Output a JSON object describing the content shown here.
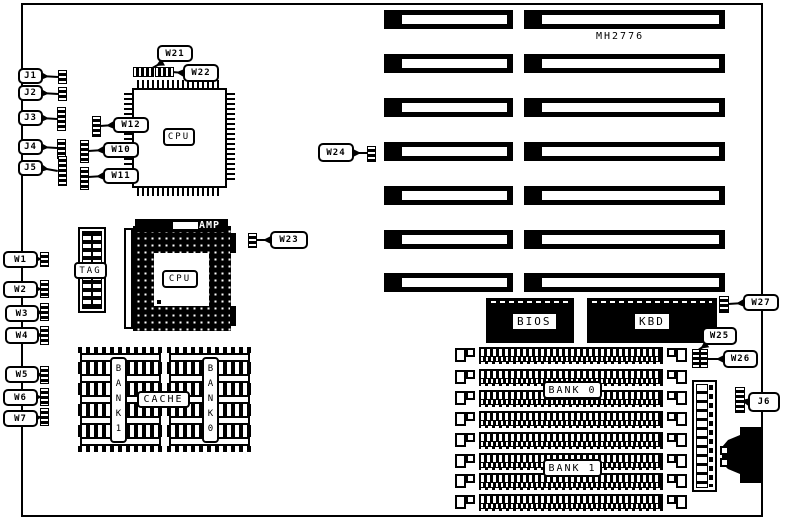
{
  "board": {
    "marking": "MH2776",
    "ink_color": "#000000",
    "paper_color": "#ffffff"
  },
  "labels": {
    "cpu_qfp": "CPU",
    "cpu_pga": "CPU",
    "amp": "AMP",
    "tag": "TAG",
    "cache": "CACHE",
    "cache_bank1": "BANK1",
    "cache_bank0": "BANK0",
    "bios": "BIOS",
    "kbd": "KBD",
    "mem_bank0": "BANK 0",
    "mem_bank1": "BANK 1"
  },
  "callouts": [
    {
      "id": "J1",
      "label": "J1",
      "box": [
        18,
        68,
        25,
        16
      ],
      "jumpers": [
        [
          58,
          70,
          9,
          14,
          "v"
        ]
      ],
      "leader": [
        41,
        76,
        58,
        77
      ]
    },
    {
      "id": "J2",
      "label": "J2",
      "box": [
        18,
        85,
        25,
        16
      ],
      "jumpers": [
        [
          58,
          87,
          9,
          14,
          "v"
        ]
      ],
      "leader": [
        41,
        93,
        58,
        94
      ]
    },
    {
      "id": "J3",
      "label": "J3",
      "box": [
        18,
        110,
        25,
        16
      ],
      "jumpers": [
        [
          57,
          107,
          9,
          24,
          "v"
        ]
      ],
      "leader": [
        41,
        118,
        57,
        119
      ]
    },
    {
      "id": "J4",
      "label": "J4",
      "box": [
        18,
        139,
        25,
        16
      ],
      "jumpers": [
        [
          57,
          139,
          9,
          20,
          "v"
        ]
      ],
      "leader": [
        41,
        147,
        57,
        148
      ]
    },
    {
      "id": "J5",
      "label": "J5",
      "box": [
        18,
        160,
        25,
        16
      ],
      "jumpers": [
        [
          58,
          156,
          9,
          30,
          "v"
        ]
      ],
      "leader": [
        41,
        168,
        58,
        171
      ]
    },
    {
      "id": "W1",
      "label": "W1",
      "box": [
        3,
        251,
        35,
        17
      ],
      "jumpers": [
        [
          40,
          252,
          9,
          15,
          "v"
        ]
      ],
      "leader": [
        34,
        259,
        41,
        259
      ]
    },
    {
      "id": "W2",
      "label": "W2",
      "box": [
        3,
        281,
        35,
        17
      ],
      "jumpers": [
        [
          40,
          280,
          9,
          18,
          "v"
        ]
      ],
      "leader": [
        34,
        289,
        41,
        289
      ]
    },
    {
      "id": "W3",
      "label": "W3",
      "box": [
        5,
        305,
        34,
        17
      ],
      "jumpers": [
        [
          40,
          303,
          9,
          18,
          "v"
        ]
      ],
      "leader": [
        35,
        313,
        41,
        312
      ]
    },
    {
      "id": "W4",
      "label": "W4",
      "box": [
        5,
        327,
        34,
        17
      ],
      "jumpers": [
        [
          40,
          326,
          9,
          19,
          "v"
        ]
      ],
      "leader": [
        35,
        335,
        41,
        335
      ]
    },
    {
      "id": "W5",
      "label": "W5",
      "box": [
        5,
        366,
        34,
        17
      ],
      "jumpers": [
        [
          40,
          366,
          9,
          18,
          "v"
        ]
      ],
      "leader": [
        35,
        374,
        41,
        375
      ]
    },
    {
      "id": "W6",
      "label": "W6",
      "box": [
        3,
        389,
        35,
        17
      ],
      "jumpers": [
        [
          40,
          388,
          9,
          18,
          "v"
        ]
      ],
      "leader": [
        34,
        397,
        41,
        397
      ]
    },
    {
      "id": "W7",
      "label": "W7",
      "box": [
        3,
        410,
        35,
        17
      ],
      "jumpers": [
        [
          40,
          408,
          9,
          18,
          "v"
        ]
      ],
      "leader": [
        34,
        418,
        41,
        417
      ]
    },
    {
      "id": "W10",
      "label": "W10",
      "box": [
        103,
        142,
        36,
        16
      ],
      "jumpers": [
        [
          80,
          140,
          9,
          23,
          "v"
        ]
      ],
      "leader": [
        104,
        150,
        88,
        151
      ]
    },
    {
      "id": "W11",
      "label": "W11",
      "box": [
        103,
        168,
        36,
        16
      ],
      "jumpers": [
        [
          80,
          167,
          9,
          23,
          "v"
        ]
      ],
      "leader": [
        104,
        176,
        88,
        177
      ]
    },
    {
      "id": "W12",
      "label": "W12",
      "box": [
        113,
        117,
        36,
        16
      ],
      "jumpers": [
        [
          92,
          116,
          9,
          21,
          "v"
        ]
      ],
      "leader": [
        114,
        125,
        100,
        126
      ]
    },
    {
      "id": "W21",
      "label": "W21",
      "box": [
        157,
        45,
        36,
        17
      ],
      "jumpers": [
        [
          133,
          67,
          21,
          10,
          "h"
        ]
      ],
      "leader": [
        163,
        62,
        147,
        71
      ]
    },
    {
      "id": "W22",
      "label": "W22",
      "box": [
        183,
        64,
        36,
        18
      ],
      "jumpers": [
        [
          155,
          67,
          19,
          10,
          "h"
        ]
      ],
      "leader": [
        184,
        73,
        172,
        72
      ]
    },
    {
      "id": "W23",
      "label": "W23",
      "box": [
        270,
        231,
        38,
        18
      ],
      "jumpers": [
        [
          248,
          233,
          9,
          15,
          "v"
        ]
      ],
      "leader": [
        271,
        240,
        256,
        240
      ]
    },
    {
      "id": "W24",
      "label": "W24",
      "box": [
        318,
        143,
        36,
        19
      ],
      "jumpers": [
        [
          367,
          146,
          9,
          16,
          "v"
        ]
      ],
      "leader": [
        353,
        153,
        367,
        153
      ]
    },
    {
      "id": "W25",
      "label": "W25",
      "box": [
        702,
        327,
        35,
        18
      ],
      "jumpers": [
        [
          692,
          349,
          8,
          19,
          "v"
        ]
      ],
      "leader": [
        707,
        344,
        697,
        351
      ]
    },
    {
      "id": "W26",
      "label": "W26",
      "box": [
        723,
        350,
        35,
        18
      ],
      "jumpers": [
        [
          700,
          349,
          8,
          19,
          "v"
        ]
      ],
      "leader": [
        724,
        359,
        707,
        359
      ]
    },
    {
      "id": "W27",
      "label": "W27",
      "box": [
        743,
        294,
        36,
        17
      ],
      "jumpers": [
        [
          719,
          296,
          10,
          17,
          "v"
        ]
      ],
      "leader": [
        744,
        303,
        728,
        304
      ]
    },
    {
      "id": "J6",
      "label": "J6",
      "box": [
        748,
        392,
        32,
        20
      ],
      "jumpers": [
        [
          735,
          387,
          10,
          26,
          "v"
        ]
      ],
      "leader": [
        749,
        402,
        744,
        401
      ]
    }
  ],
  "isa_slots": {
    "rows_y": [
      10,
      54,
      98,
      142,
      186,
      230,
      273
    ],
    "height": 19,
    "left_x": 384,
    "left_w": 129,
    "right_x": 524,
    "right_w": 201
  },
  "simm_sockets": {
    "x": 455,
    "w": 232,
    "h": 17,
    "rows_y": [
      347,
      369,
      390,
      411,
      432,
      453,
      473,
      494
    ]
  },
  "cache_chips": {
    "group_x": [
      78,
      167
    ],
    "chip_w": 85,
    "chip_h": 21,
    "rows_y": [
      347,
      368,
      389,
      410,
      431
    ]
  }
}
